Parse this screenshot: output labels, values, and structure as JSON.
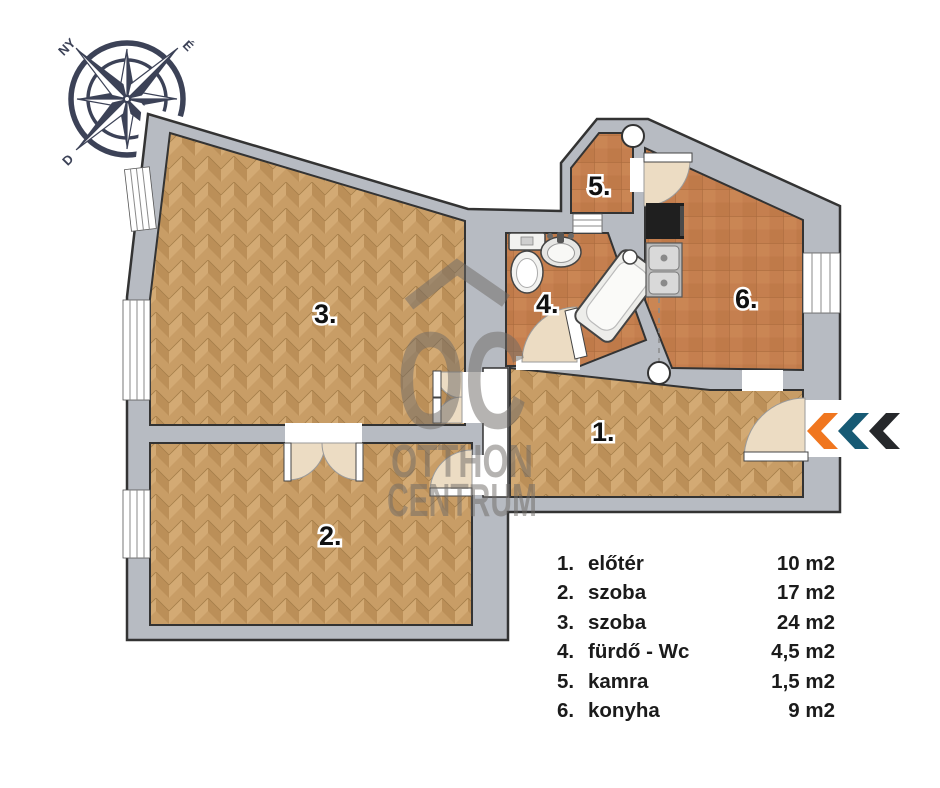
{
  "compass": {
    "west_label": "NY",
    "north_label": "É",
    "south_label": "D"
  },
  "rooms": [
    {
      "num": "1.",
      "name": "előtér",
      "area": "10 m2"
    },
    {
      "num": "2.",
      "name": "szoba",
      "area": "17 m2"
    },
    {
      "num": "3.",
      "name": "szoba",
      "area": "24 m2"
    },
    {
      "num": "4.",
      "name": "fürdő - Wc",
      "area": "4,5 m2"
    },
    {
      "num": "5.",
      "name": "kamra",
      "area": "1,5 m2"
    },
    {
      "num": "6.",
      "name": "konyha",
      "area": "9 m2"
    }
  ],
  "watermark": {
    "monogram": "OC",
    "line1": "OTTHON",
    "line2": "CENTRUM"
  },
  "entrance": {
    "chevron_colors": [
      "#f0761f",
      "#175a74",
      "#26282b"
    ]
  },
  "colors": {
    "wall": "#b7bbc2",
    "parquet": "#c89d66",
    "tile": "#c57f4f",
    "compass": "#3c4257",
    "accent-orange": "#f0761f",
    "accent-teal": "#175a74",
    "accent-dark": "#26282b"
  }
}
